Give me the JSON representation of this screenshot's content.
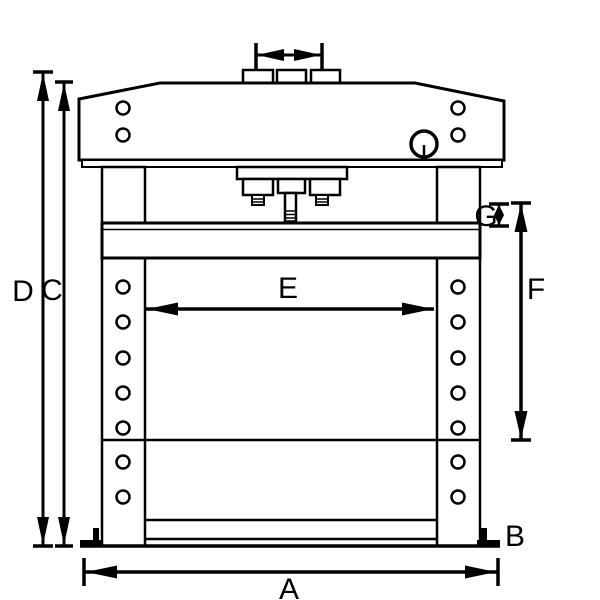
{
  "diagram": {
    "background_color": "#ffffff",
    "line_color": "#000000",
    "dimension_labels": {
      "a": "A",
      "b": "B",
      "c": "C",
      "d": "D",
      "e": "E",
      "f": "F",
      "g": "G"
    }
  }
}
